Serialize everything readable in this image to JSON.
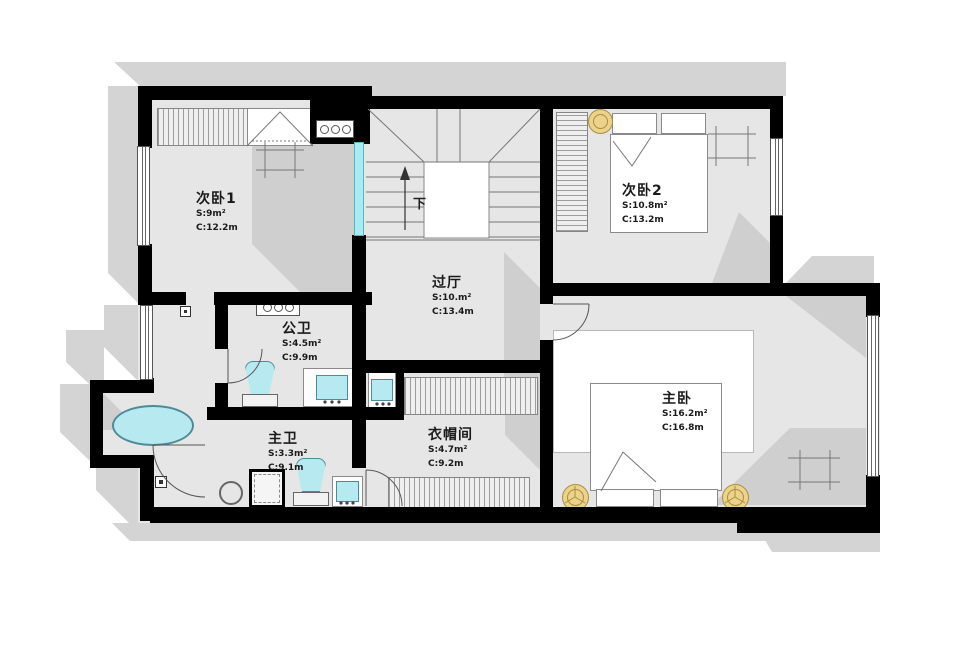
{
  "plan": {
    "rooms": [
      {
        "name": "次卧1",
        "area": "S:9m²",
        "circumference": "C:12.2m"
      },
      {
        "name": "次卧2",
        "area": "S:10.8m²",
        "circumference": "C:13.2m"
      },
      {
        "name": "过厅",
        "area": "S:10.m²",
        "circumference": "C:13.4m"
      },
      {
        "name": "公卫",
        "area": "S:4.5m²",
        "circumference": "C:9.9m"
      },
      {
        "name": "主卫",
        "area": "S:3.3m²",
        "circumference": "C:9.1m"
      },
      {
        "name": "衣帽间",
        "area": "S:4.7m²",
        "circumference": "C:9.2m"
      },
      {
        "name": "主卧",
        "area": "S:16.2m²",
        "circumference": "C:16.8m"
      }
    ],
    "stairs_label": "下",
    "colors": {
      "wall": "#000000",
      "floor": "#e6e6e6",
      "outer_shadow": "#d4d4d4",
      "inner_shadow": "#cfcfcf",
      "fixture_fill": "#b7eaf0",
      "fixture_border": "#4e8b99",
      "glass": "#a8ecf2",
      "gold": "#ecd28a",
      "gold_border": "#a68f3e",
      "line": "#777777",
      "furniture_border": "#8a8a8a"
    }
  }
}
